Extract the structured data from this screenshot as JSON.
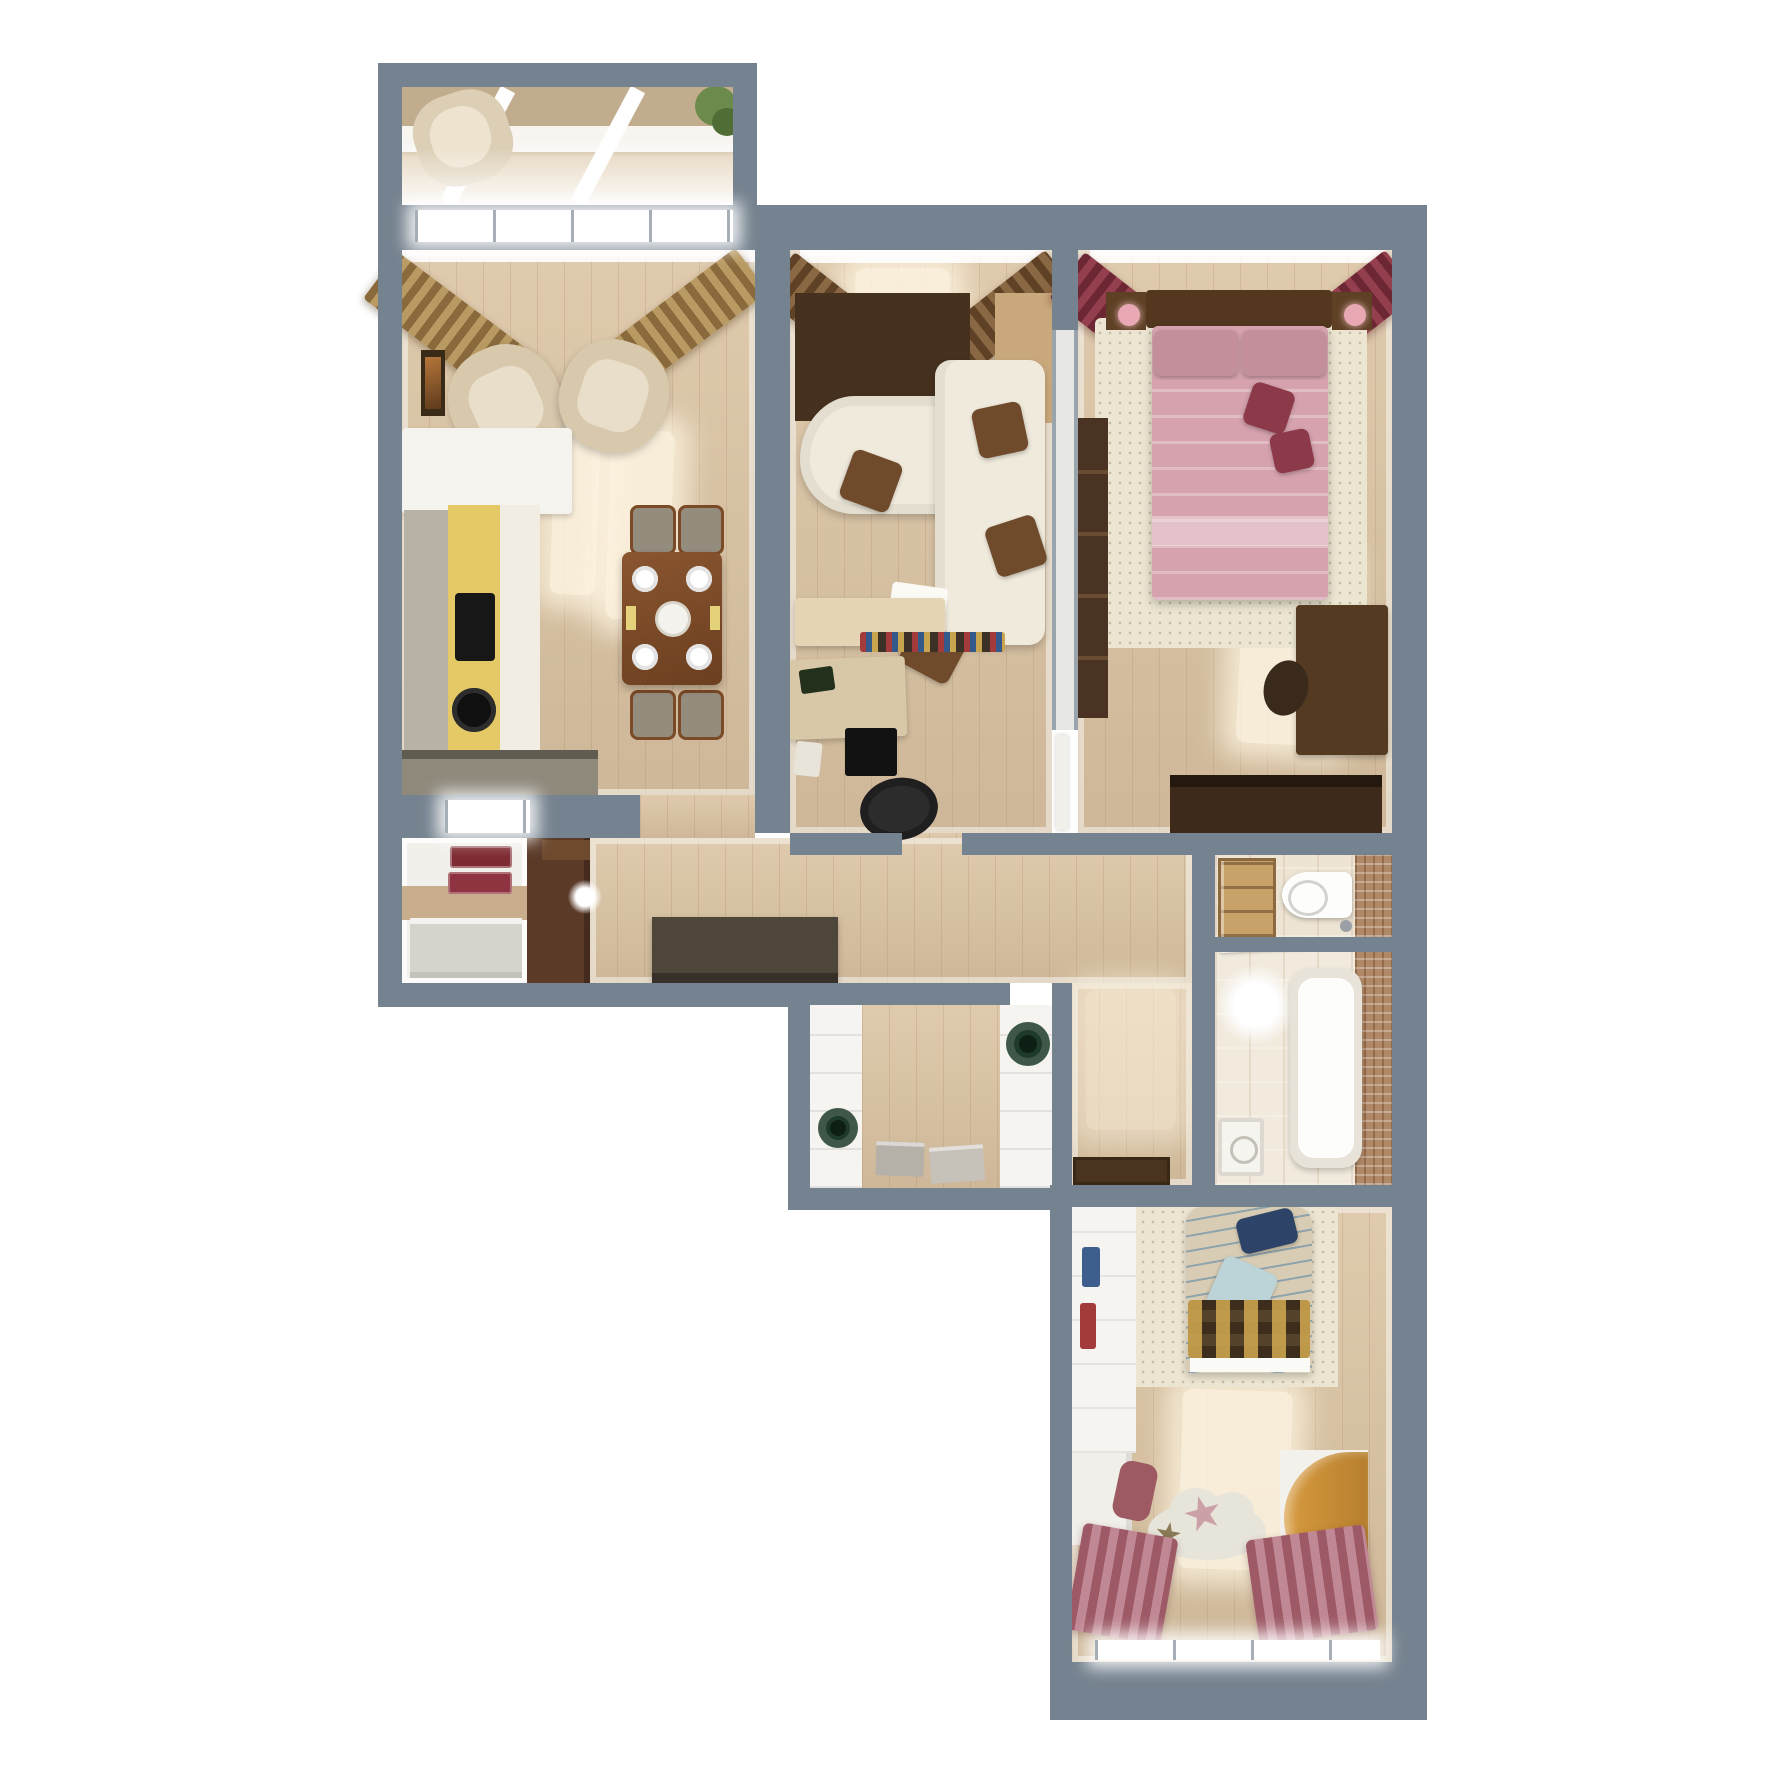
{
  "title": "3D apartment floor plan (top-down render)",
  "rooms": [
    {
      "id": "balcony",
      "name": "Balcony"
    },
    {
      "id": "kitchen-living",
      "name": "Kitchen and dining room"
    },
    {
      "id": "lounge-study",
      "name": "Lounge and study"
    },
    {
      "id": "master-bedroom",
      "name": "Master bedroom"
    },
    {
      "id": "hallway",
      "name": "Hallway"
    },
    {
      "id": "pantry",
      "name": "Pantry"
    },
    {
      "id": "walk-in-closet",
      "name": "Walk-in closet"
    },
    {
      "id": "wc",
      "name": "WC"
    },
    {
      "id": "bathroom",
      "name": "Bathroom"
    },
    {
      "id": "kids-bedroom",
      "name": "Kids bedroom"
    },
    {
      "id": "entry",
      "name": "Entry corridor"
    }
  ],
  "palette": {
    "wall": "#75828F",
    "floor_wood": "#DBC3A2",
    "sofa_cream": "#F0EADC",
    "wood_dark": "#46301E",
    "walnut": "#5A3B22",
    "beige_console": "#E6D5B5",
    "bed_pink": "#D5A2AE",
    "bed_pillow": "#C28F9B",
    "accent_burgundy": "#8C3A4A",
    "kitchen_yellow": "#E5C967",
    "counter_gray": "#8F897C",
    "rug_cream": "#ECE5D2",
    "mosaic_brown": "#B08968",
    "basket_green": "#1E3A2A",
    "navy_pillow": "#2D4468",
    "blue_pillow": "#BCD3D8",
    "wood_round": "#C98F42",
    "suitcase_red": "#7E2B33",
    "doormat_brown": "#4A3420"
  }
}
